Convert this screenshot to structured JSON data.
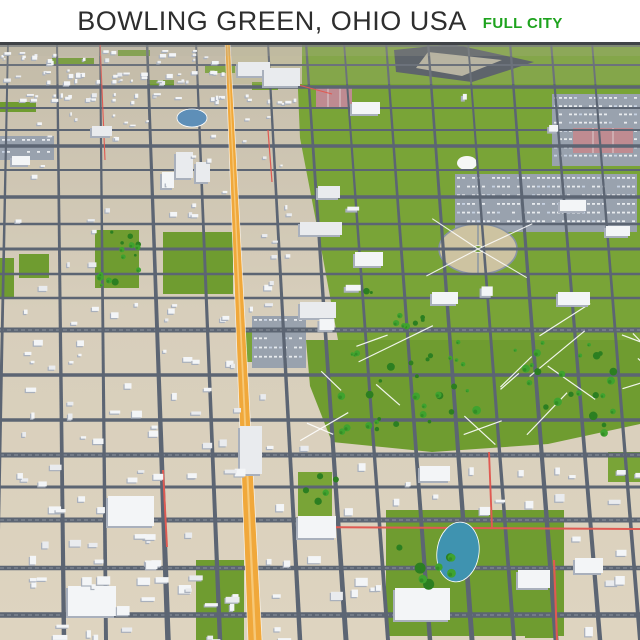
{
  "header": {
    "title": "BOWLING GREEN, OHIO USA",
    "badge": "FULL CITY",
    "title_color": "#2e2e2e",
    "badge_color": "#1ea31e"
  },
  "map": {
    "width": 640,
    "height": 598,
    "seed": 11,
    "colors": {
      "ground_top": "#c6beab",
      "ground_mid": "#d7cebb",
      "ground_bottom": "#ded4c0",
      "campus_green": "#79a437",
      "campus_green2": "#6f9c30",
      "road": "#5c6573",
      "road_dash": "#ffffff",
      "highway": "#f0a83b",
      "highway_stripe": "#f6c878",
      "red_road": "#e05a52",
      "building": "#f3f5f7",
      "building_alt": "#e9ebee",
      "building_side": "#a9b0bc",
      "tree": "#3fa32f",
      "tree_dark": "#2c7f21",
      "water1": "#5e8fb8",
      "water2": "#3f93b0",
      "plaza": "#cdc3a1",
      "plaza_ring": "#8893a2",
      "court": "#bf8b91",
      "parking": "#99a2ae",
      "parking_stripe": "#e8ebee",
      "horizon": "#404347",
      "haze": "#b5b2a2",
      "path": "#ffffff",
      "tan_block": "#c5bfa0"
    },
    "h_roads": [
      [
        4,
        1.5
      ],
      [
        23,
        2
      ],
      [
        45,
        3.5
      ],
      [
        66,
        2
      ],
      [
        88,
        2
      ],
      [
        104,
        3.5
      ],
      [
        128,
        2
      ],
      [
        155,
        3.5
      ],
      [
        182,
        2.5
      ],
      [
        207,
        3
      ],
      [
        232,
        2.5
      ],
      [
        256,
        2.5
      ],
      [
        288,
        5
      ],
      [
        333,
        3.5
      ],
      [
        378,
        3.5
      ],
      [
        413,
        5
      ],
      [
        445,
        3
      ],
      [
        478,
        5
      ],
      [
        526,
        4.5
      ],
      [
        573,
        5.5
      ]
    ],
    "v_roads": [
      [
        8,
        -4,
        4
      ],
      [
        57,
        64,
        4.5
      ],
      [
        100,
        106,
        4
      ],
      [
        147,
        168,
        5.5
      ],
      [
        196,
        220,
        4.5
      ],
      [
        268,
        300,
        4.5
      ],
      [
        306,
        346,
        5
      ],
      [
        344,
        388,
        4
      ],
      [
        386,
        430,
        4.5
      ],
      [
        428,
        472,
        5
      ],
      [
        468,
        514,
        4
      ],
      [
        510,
        556,
        5
      ],
      [
        551,
        600,
        4.5
      ],
      [
        592,
        640,
        4
      ]
    ],
    "highway": {
      "top": [
        225,
        230
      ],
      "bottom": [
        248,
        262
      ]
    },
    "red_roads": [
      [
        100,
        0,
        105,
        118
      ],
      [
        250,
        30,
        332,
        52
      ],
      [
        300,
        485,
        640,
        487
      ],
      [
        489,
        410,
        492,
        486
      ],
      [
        554,
        518,
        557,
        598
      ],
      [
        163,
        428,
        167,
        505
      ],
      [
        268,
        88,
        272,
        140
      ]
    ],
    "green_polys": [
      [
        [
          296,
          0
        ],
        [
          640,
          0
        ],
        [
          640,
          298
        ],
        [
          338,
          298
        ],
        [
          320,
          200
        ],
        [
          300,
          96
        ]
      ],
      [
        [
          306,
          298
        ],
        [
          640,
          298
        ],
        [
          640,
          382
        ],
        [
          548,
          402
        ],
        [
          432,
          410
        ],
        [
          332,
          400
        ],
        [
          310,
          344
        ]
      ]
    ],
    "green_rects": [
      [
        95,
        188,
        44,
        58
      ],
      [
        19,
        212,
        30,
        24
      ],
      [
        163,
        190,
        70,
        62
      ],
      [
        386,
        468,
        178,
        126
      ],
      [
        52,
        16,
        42,
        7
      ],
      [
        118,
        8,
        32,
        6
      ],
      [
        205,
        24,
        30,
        7
      ],
      [
        148,
        38,
        26,
        6
      ],
      [
        0,
        60,
        36,
        10
      ],
      [
        252,
        40,
        26,
        8
      ],
      [
        246,
        286,
        14,
        34
      ],
      [
        196,
        518,
        48,
        80
      ],
      [
        298,
        430,
        34,
        52
      ],
      [
        525,
        518,
        30,
        78
      ],
      [
        0,
        216,
        14,
        40
      ],
      [
        608,
        410,
        32,
        30
      ]
    ],
    "tan_blocks": [
      [
        232,
        0,
        70,
        42
      ]
    ],
    "parking_lots": [
      [
        552,
        52,
        88,
        72
      ],
      [
        455,
        132,
        182,
        58
      ],
      [
        0,
        94,
        54,
        24
      ],
      [
        252,
        274,
        54,
        52
      ]
    ],
    "plaza": {
      "cx": 478,
      "cy": 207,
      "rx": 39,
      "ry": 25
    },
    "dome": {
      "cx": 467,
      "cy": 121,
      "rx": 10,
      "ry": 7
    },
    "stadium": {
      "dark": [
        [
          394,
          8
        ],
        [
          452,
          2
        ],
        [
          534,
          20
        ],
        [
          472,
          40
        ],
        [
          396,
          30
        ]
      ],
      "light": [
        [
          428,
          10
        ],
        [
          502,
          18
        ],
        [
          462,
          34
        ],
        [
          416,
          26
        ]
      ]
    },
    "courts": [
      [
        316,
        44,
        36,
        22
      ],
      [
        573,
        86,
        60,
        25
      ]
    ],
    "ponds": [
      [
        192,
        76,
        15,
        9,
        0
      ],
      [
        458,
        510,
        21,
        30,
        8
      ]
    ],
    "tree_clusters": [
      [
        96,
        190,
        44,
        54,
        16
      ],
      [
        335,
        298,
        148,
        100,
        32
      ],
      [
        515,
        298,
        100,
        58,
        16
      ],
      [
        545,
        350,
        70,
        42,
        9
      ],
      [
        395,
        498,
        70,
        45,
        8
      ],
      [
        302,
        428,
        45,
        35,
        5
      ],
      [
        360,
        248,
        64,
        42,
        9
      ]
    ],
    "landmarks": [
      [
        238,
        20,
        32,
        14
      ],
      [
        264,
        26,
        36,
        18
      ],
      [
        352,
        60,
        28,
        12
      ],
      [
        176,
        110,
        17,
        26
      ],
      [
        196,
        120,
        14,
        20
      ],
      [
        162,
        130,
        12,
        16
      ],
      [
        300,
        180,
        42,
        13
      ],
      [
        318,
        144,
        22,
        12
      ],
      [
        355,
        210,
        28,
        14
      ],
      [
        432,
        250,
        26,
        12
      ],
      [
        558,
        250,
        32,
        13
      ],
      [
        300,
        260,
        36,
        16
      ],
      [
        68,
        544,
        48,
        30
      ],
      [
        108,
        454,
        46,
        30
      ],
      [
        298,
        474,
        38,
        22
      ],
      [
        420,
        424,
        30,
        15
      ],
      [
        518,
        528,
        32,
        18
      ],
      [
        240,
        384,
        22,
        48
      ],
      [
        575,
        516,
        28,
        15
      ],
      [
        92,
        84,
        20,
        10
      ],
      [
        12,
        114,
        18,
        9
      ],
      [
        560,
        158,
        26,
        11
      ],
      [
        606,
        184,
        24,
        10
      ],
      [
        395,
        546,
        55,
        32
      ]
    ],
    "campus_rects": [
      [
        296,
        0,
        344,
        296
      ],
      [
        304,
        296,
        336,
        114
      ]
    ],
    "exclusions": [
      [
        95,
        186,
        46,
        62
      ],
      [
        17,
        208,
        34,
        28
      ],
      [
        161,
        186,
        74,
        68
      ],
      [
        384,
        466,
        184,
        130
      ],
      [
        550,
        50,
        92,
        76
      ],
      [
        453,
        130,
        186,
        62
      ],
      [
        436,
        178,
        86,
        56
      ],
      [
        392,
        0,
        146,
        44
      ],
      [
        314,
        42,
        40,
        26
      ],
      [
        571,
        84,
        64,
        29
      ],
      [
        174,
        62,
        38,
        26
      ],
      [
        250,
        272,
        58,
        56
      ],
      [
        333,
        296,
        152,
        104
      ],
      [
        513,
        296,
        104,
        62
      ],
      [
        543,
        348,
        74,
        46
      ],
      [
        358,
        246,
        64,
        46
      ],
      [
        300,
        426,
        48,
        38
      ],
      [
        232,
        0,
        72,
        44
      ],
      [
        262,
        24,
        42,
        24
      ]
    ],
    "paths_zone": [
      300,
      290,
      340,
      128
    ],
    "counts": {
      "houses": 680,
      "top_houses": 240,
      "paths": 18
    }
  }
}
